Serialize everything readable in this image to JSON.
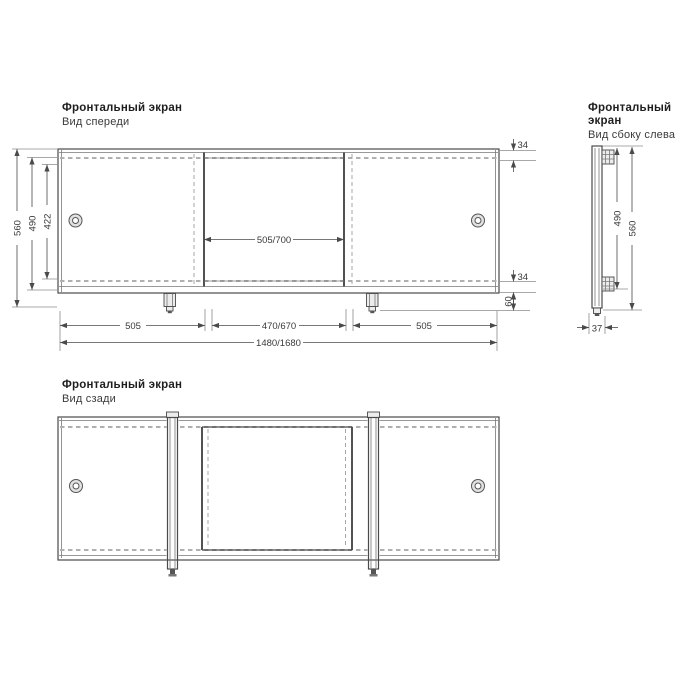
{
  "front_view": {
    "title": "Фронтальный экран",
    "subtitle": "Вид спереди",
    "dims": {
      "top_inset": "34",
      "total_height": "560",
      "inner_height": "490",
      "panel_height": "422",
      "center_panel_width": "505/700",
      "bottom_inset": "34",
      "leg_drop": "60",
      "span_left": "505",
      "span_center": "470/670",
      "span_right": "505",
      "overall_width": "1480/1680"
    }
  },
  "side_view": {
    "title": "Фронтальный экран",
    "subtitle": "Вид сбоку слева",
    "dims": {
      "inner_height": "490",
      "total_height": "560",
      "depth": "37"
    }
  },
  "rear_view": {
    "title": "Фронтальный экран",
    "subtitle": "Вид сзади"
  },
  "colors": {
    "line": "#4a4a4a",
    "dash_line": "#b0b0b0",
    "dimension_text": "#3a3a3a",
    "background": "#ffffff"
  }
}
